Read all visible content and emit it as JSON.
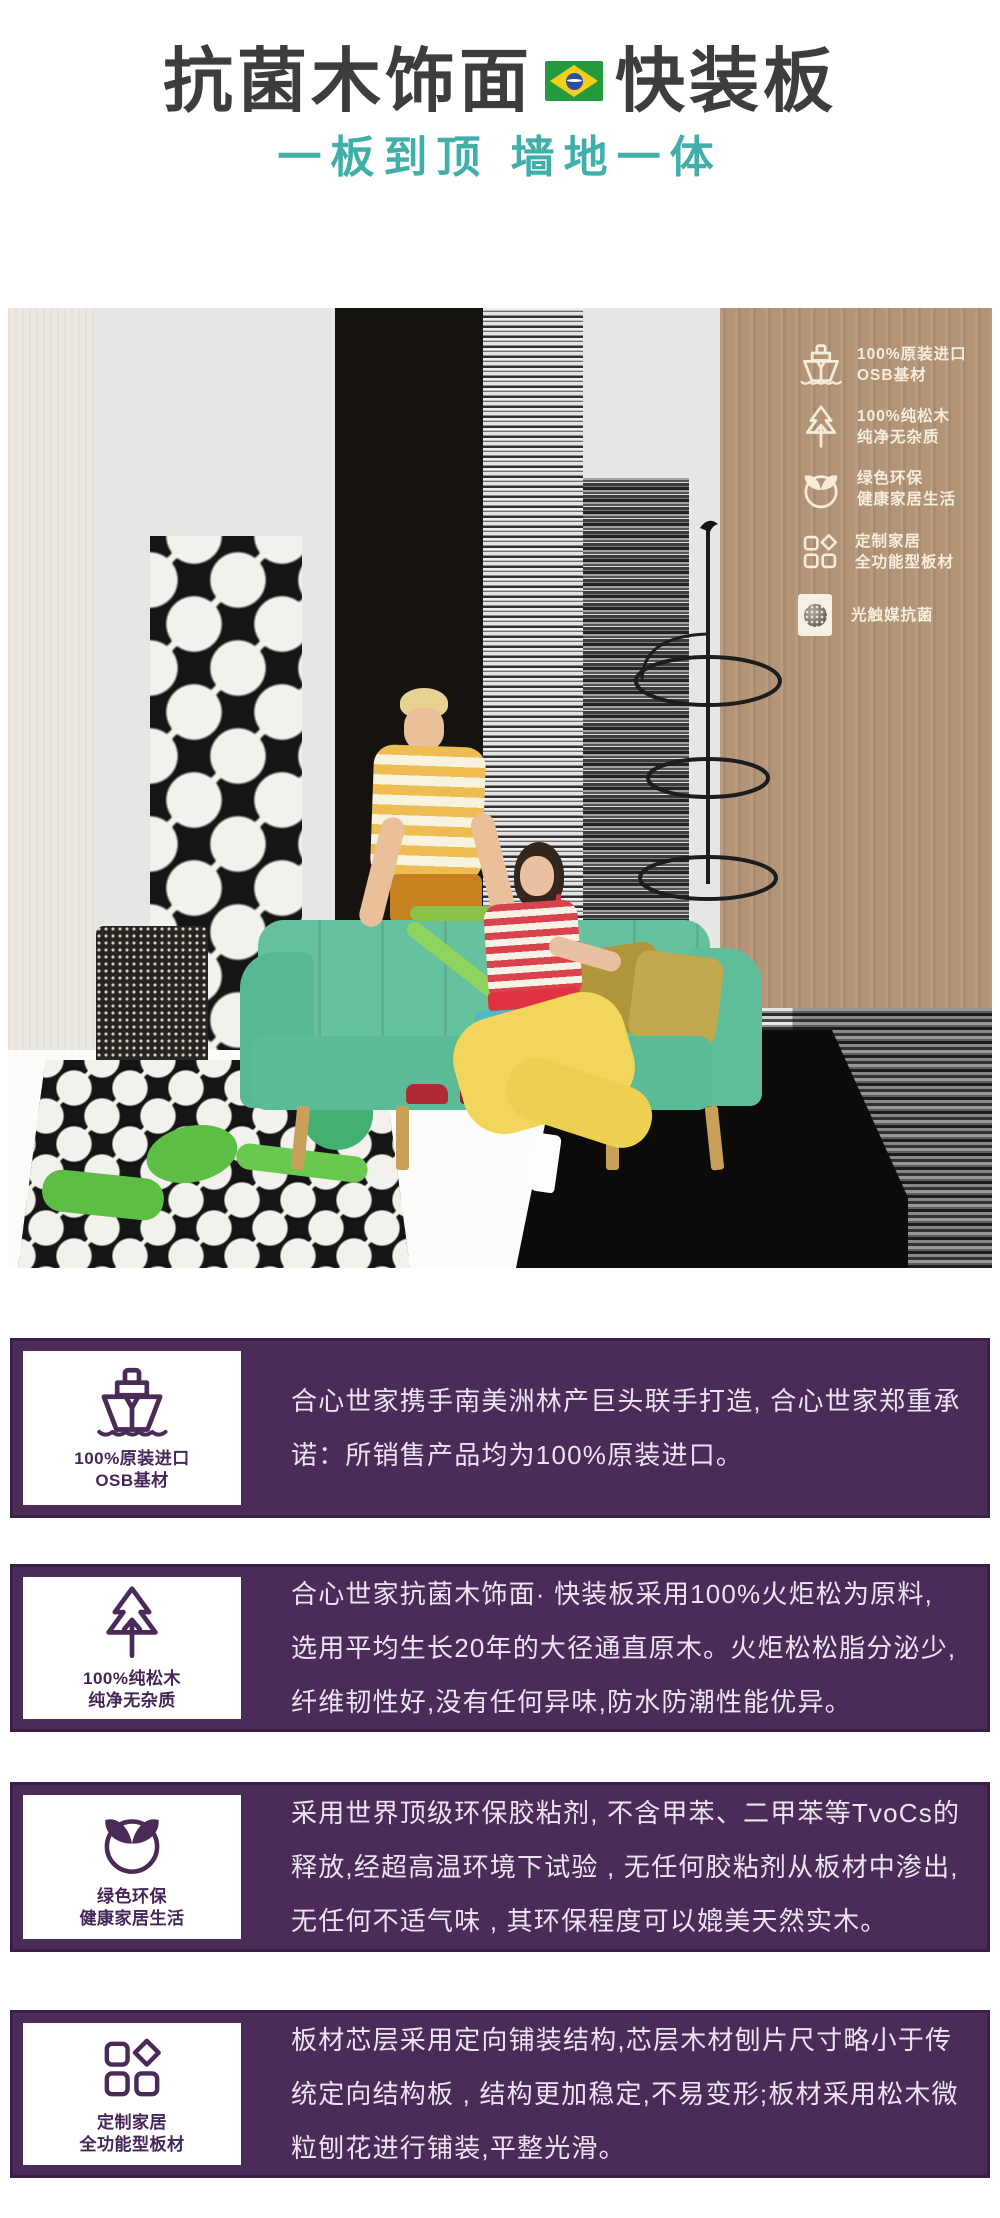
{
  "header": {
    "title_left": "抗菌木饰面",
    "title_right": "快装板",
    "flag_name": "brazil-flag",
    "subtitle": "一板到顶 墙地一体"
  },
  "photo_features": [
    {
      "icon": "ship-icon",
      "lines": [
        "100%原装进口",
        "OSB基材"
      ]
    },
    {
      "icon": "pine-tree-icon",
      "lines": [
        "100%纯松木",
        "纯净无杂质"
      ]
    },
    {
      "icon": "eco-leaf-icon",
      "lines": [
        "绿色环保",
        "健康家居生活"
      ]
    },
    {
      "icon": "panel-grid-icon",
      "lines": [
        "定制家居",
        "全功能型板材"
      ]
    },
    {
      "icon": "photocatalyst-icon",
      "lines": [
        "光触媒抗菌"
      ]
    }
  ],
  "cards": [
    {
      "icon": "ship-icon",
      "icon_label": [
        "100%原装进口",
        "OSB基材"
      ],
      "text": "合心世家携手南美洲林产巨头联手打造, 合心世家郑重承诺：所销售产品均为100%原装进口。"
    },
    {
      "icon": "pine-tree-icon",
      "icon_label": [
        "100%纯松木",
        "纯净无杂质"
      ],
      "text": "合心世家抗菌木饰面· 快装板采用100%火炬松为原料, 选用平均生长20年的大径通直原木。火炬松松脂分泌少, 纤维韧性好,没有任何异味,防水防潮性能优异。"
    },
    {
      "icon": "eco-leaf-icon",
      "icon_label": [
        "绿色环保",
        "健康家居生活"
      ],
      "text": "采用世界顶级环保胶粘剂, 不含甲苯、二甲苯等TvoCs的释放,经超高温环境下试验 , 无任何胶粘剂从板材中渗出, 无任何不适气味 , 其环保程度可以媲美天然实木。"
    },
    {
      "icon": "panel-grid-icon",
      "icon_label": [
        "定制家居",
        "全功能型板材"
      ],
      "text": "板材芯层采用定向铺装结构,芯层木材刨片尺寸略小于传统定向结构板 , 结构更加稳定,不易变形;板材采用松木微粒刨花进行铺装,平整光滑。"
    }
  ],
  "colors": {
    "title_text": "#3d3d3d",
    "subtitle_teal": "#41afa9",
    "card_purple": "#4b2b58",
    "card_border": "#3a1e47",
    "card_text": "#ece3f3",
    "icon_purple": "#4a2a57",
    "wood_tan": "#b39477",
    "sofa_mint": "#65c19e",
    "feature_cream": "#f5eedd",
    "flag_green": "#249a3e",
    "flag_yellow": "#f2cf1b",
    "flag_blue": "#2a4fa0"
  }
}
